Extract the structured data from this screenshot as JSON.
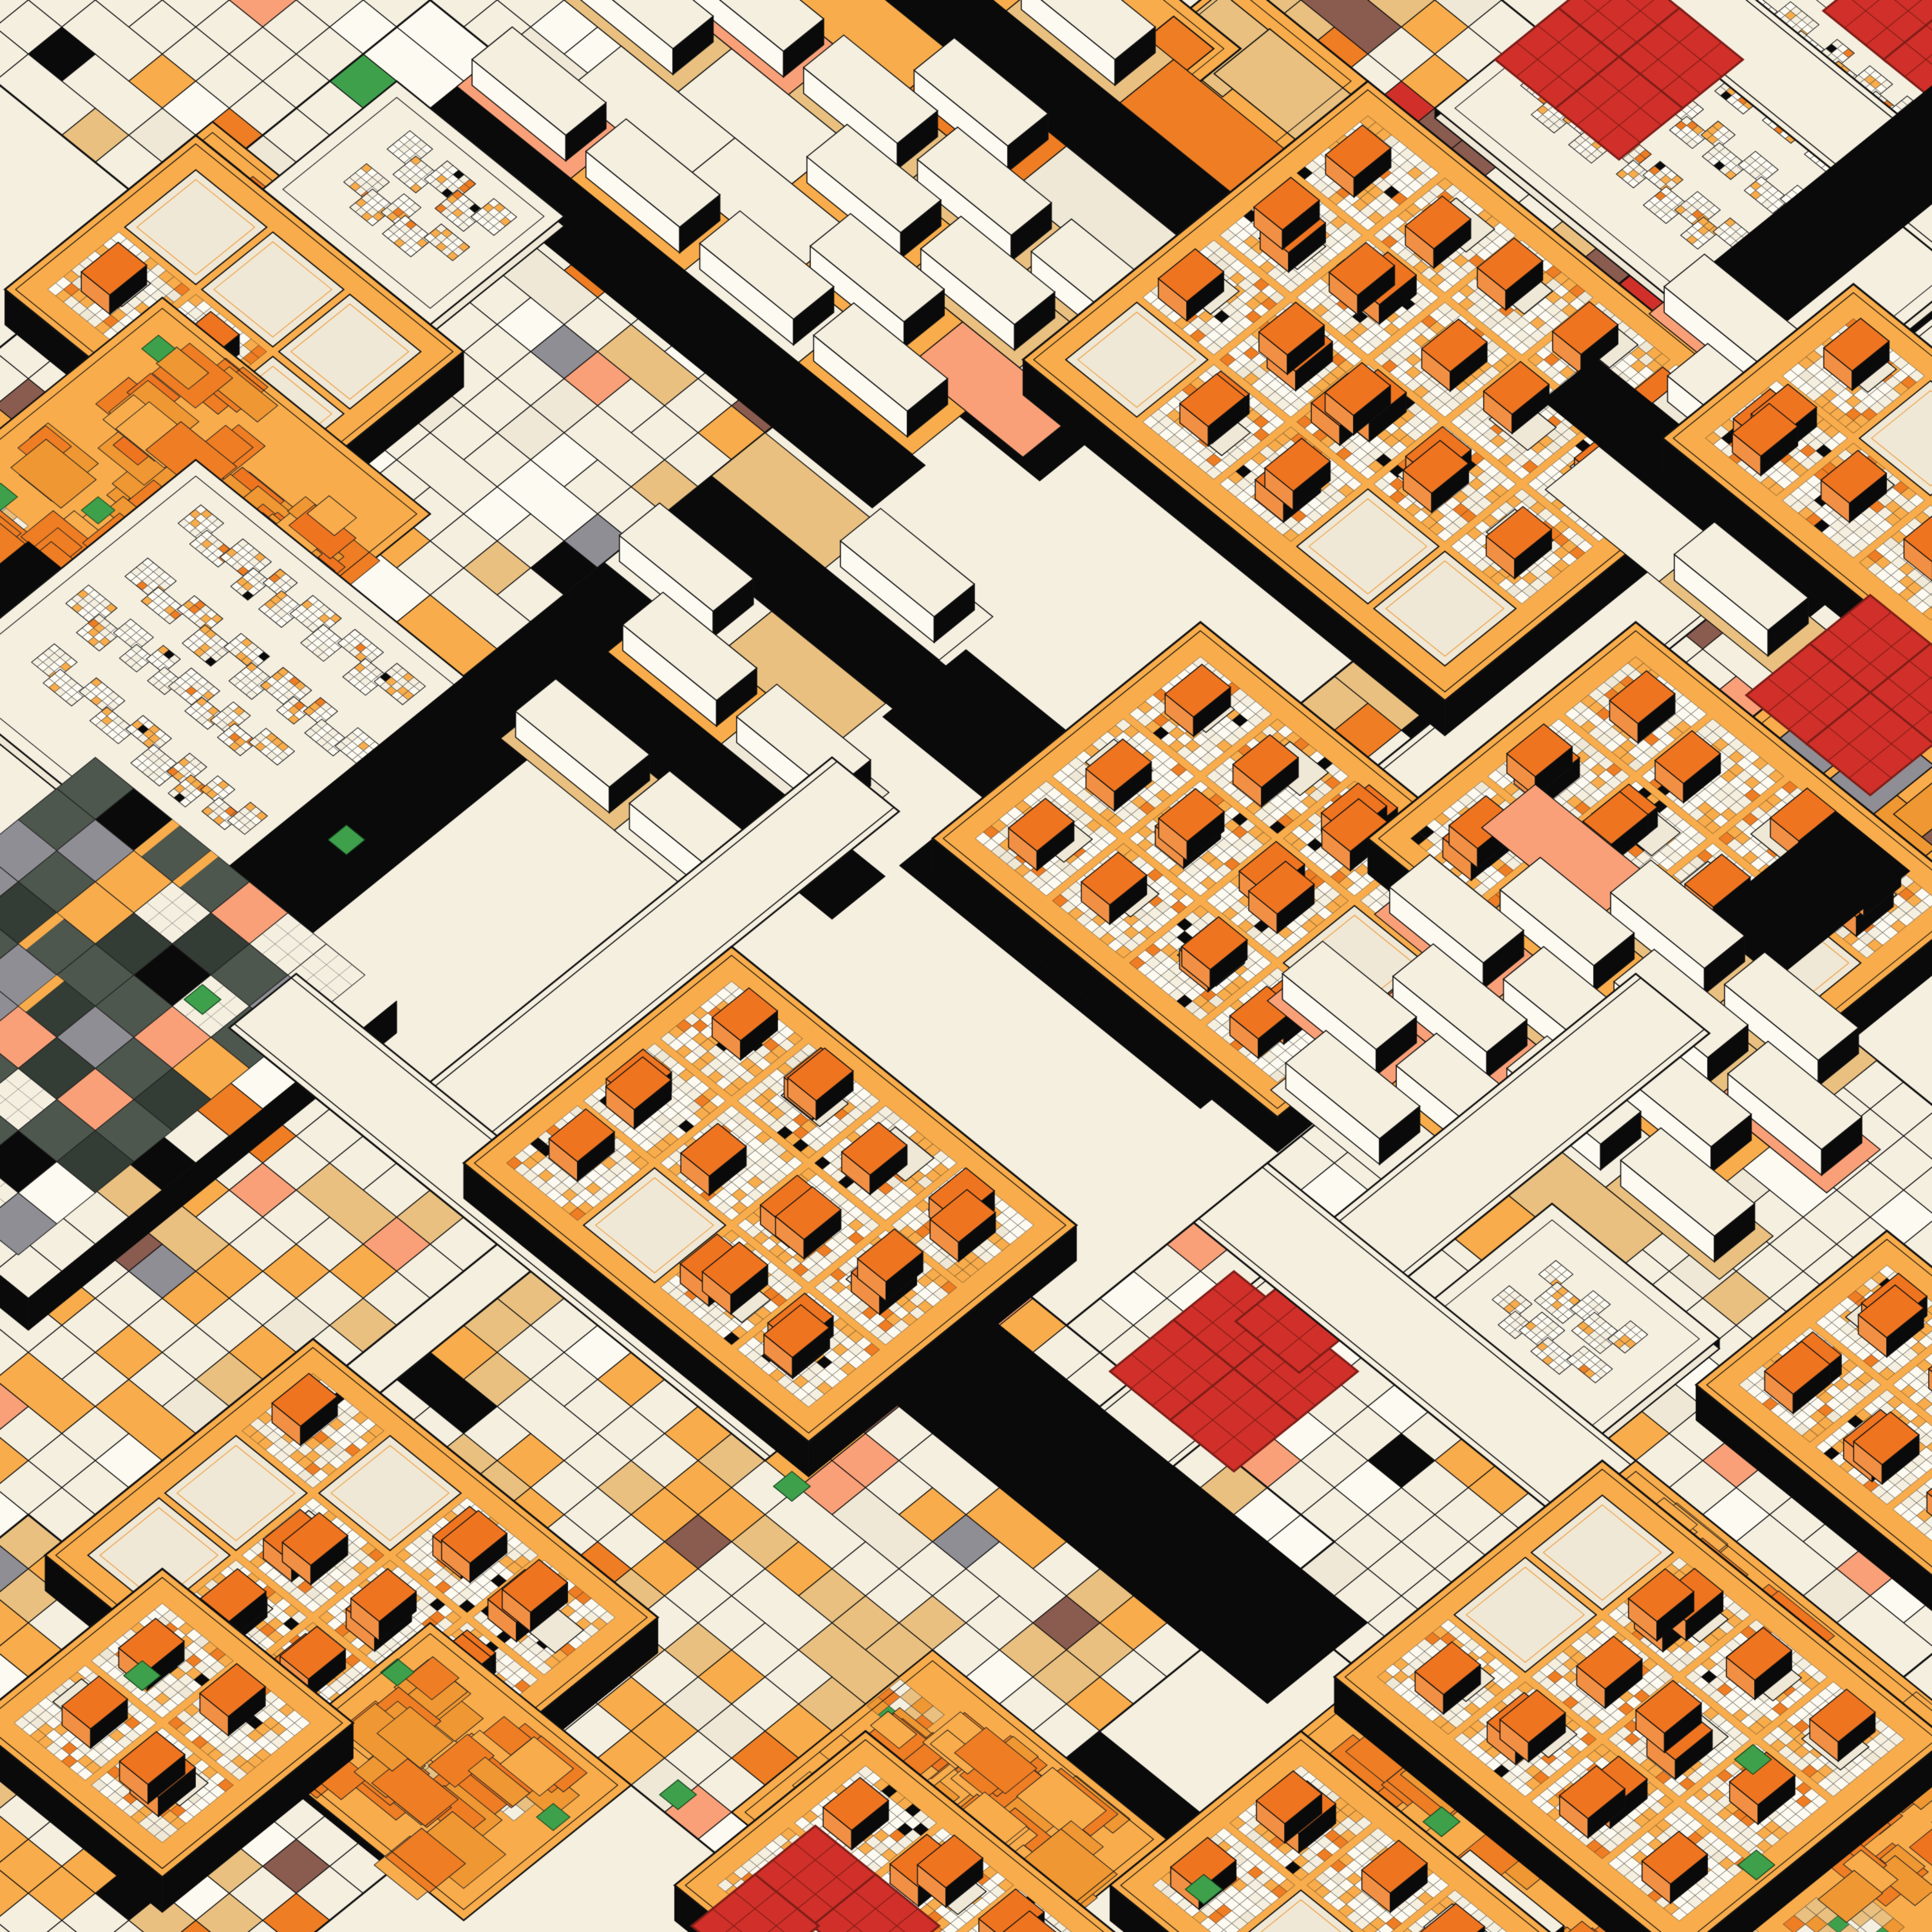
{
  "artwork": {
    "kind": "generative-isometric-circuit-city",
    "background": "#F5EFE0",
    "palette": {
      "cream": "#F5EFE0",
      "cream2": "#EFE8D6",
      "white": "#FDFAF1",
      "ink": "#111111",
      "black": "#0A0A0A",
      "amber": "#F8AC4B",
      "amberDeep": "#EF9732",
      "orange": "#EE7D23",
      "chipTop": "#EF7420",
      "chipSide": "#F19045",
      "tan": "#E9C080",
      "salmon": "#F9A078",
      "gray": "#8F8E94",
      "grayLight": "#B9B8BE",
      "brown": "#8A5B4F",
      "red": "#D03029",
      "redDark": "#7E1D18",
      "green": "#3FA04C",
      "slate": "#4D574E",
      "slateDark": "#343D35"
    },
    "grid": {
      "originX": 1500,
      "originY": 0,
      "axisX": 52,
      "axisY": 42,
      "seed": 20240613
    },
    "styles": {
      "mosaicLight": [
        [
          "cream",
          60
        ],
        [
          "white",
          14
        ],
        [
          "cream2",
          8
        ],
        [
          "amber",
          5
        ],
        [
          "tan",
          4
        ],
        [
          "salmon",
          2
        ],
        [
          "gray",
          1.5
        ],
        [
          "black",
          1.5
        ],
        [
          "brown",
          1
        ],
        [
          "orange",
          1
        ],
        [
          "green",
          0.4
        ],
        [
          "red",
          0.3
        ]
      ],
      "mosaicWarm": [
        [
          "cream",
          38
        ],
        [
          "tan",
          18
        ],
        [
          "amber",
          16
        ],
        [
          "salmon",
          7
        ],
        [
          "white",
          6
        ],
        [
          "orange",
          4
        ],
        [
          "cream2",
          4
        ],
        [
          "gray",
          2
        ],
        [
          "brown",
          2
        ],
        [
          "black",
          2
        ],
        [
          "green",
          0.4
        ],
        [
          "red",
          0.3
        ]
      ],
      "fine": [
        [
          "white",
          40
        ],
        [
          "cream",
          28
        ],
        [
          "amber",
          20
        ],
        [
          "orange",
          6
        ],
        [
          "cream2",
          4
        ],
        [
          "black",
          2
        ]
      ],
      "panelCell": [
        [
          "white",
          52
        ],
        [
          "cream",
          30
        ],
        [
          "amber",
          13
        ],
        [
          "orange",
          3
        ],
        [
          "black",
          1
        ]
      ],
      "slabGround": [
        [
          "tan",
          30
        ],
        [
          "amber",
          26
        ],
        [
          "cream",
          26
        ],
        [
          "salmon",
          9
        ],
        [
          "cream2",
          5
        ],
        [
          "orange",
          4
        ]
      ],
      "afStack": [
        [
          "orange",
          45
        ],
        [
          "amberDeep",
          30
        ],
        [
          "amber",
          20
        ],
        [
          "chipTop",
          5
        ]
      ],
      "afChecker": [
        [
          "tan",
          40
        ],
        [
          "cream",
          30
        ],
        [
          "amberDeep",
          18
        ],
        [
          "orange",
          7
        ],
        [
          "green",
          5
        ]
      ],
      "slateMix": [
        [
          "slate",
          40
        ],
        [
          "slateDark",
          12
        ],
        [
          "cream",
          17
        ],
        [
          "salmon",
          9
        ],
        [
          "gray",
          7
        ],
        [
          "amber",
          5
        ],
        [
          "black",
          6
        ],
        [
          "white",
          4
        ]
      ]
    },
    "elements": [
      {
        "type": "mosaic",
        "u": -18,
        "v": -2,
        "w": 16,
        "h": 18,
        "style": "mosaicLight"
      },
      {
        "type": "mosaic",
        "u": -14,
        "v": -10,
        "w": 12,
        "h": 9,
        "style": "mosaicWarm"
      },
      {
        "type": "mosaic",
        "u": 2,
        "v": -8,
        "w": 13,
        "h": 9,
        "style": "mosaicWarm"
      },
      {
        "type": "mosaic",
        "u": 10,
        "v": -17,
        "w": 9,
        "h": 6,
        "style": "mosaicWarm"
      },
      {
        "type": "mosaic",
        "u": 15,
        "v": -12,
        "w": 14,
        "h": 12,
        "style": "mosaicWarm"
      },
      {
        "type": "mosaic",
        "u": -8,
        "v": 8,
        "w": 13,
        "h": 15,
        "style": "mosaicLight"
      },
      {
        "type": "mosaic",
        "u": 18,
        "v": 0,
        "w": 13,
        "h": 11,
        "style": "mosaicWarm"
      },
      {
        "type": "mosaic",
        "u": 26,
        "v": 6,
        "w": 19,
        "h": 19,
        "style": "mosaicLight"
      },
      {
        "type": "mosaic",
        "u": 17,
        "v": 23,
        "w": 17,
        "h": 15,
        "style": "mosaicWarm"
      },
      {
        "type": "mosaic",
        "u": 2,
        "v": 30,
        "w": 14,
        "h": 14,
        "style": "mosaicWarm"
      },
      {
        "type": "mosaic",
        "u": 14,
        "v": 42,
        "w": 12,
        "h": 10,
        "style": "mosaicWarm"
      },
      {
        "type": "flatplate",
        "u": -15,
        "v": -4,
        "w": 9,
        "h": 6.5,
        "bars": "grayBrown"
      },
      {
        "type": "flatplate",
        "u": -6.5,
        "v": -8,
        "w": 8,
        "h": 5.5,
        "bars": "gray"
      },
      {
        "type": "flatplate",
        "u": 3.5,
        "v": -4.5,
        "w": 4,
        "h": 3,
        "bars": "plain"
      },
      {
        "type": "flatplate",
        "u": 0,
        "v": -3.2,
        "w": 5,
        "h": 3.2,
        "bars": "orangeCell"
      },
      {
        "type": "amberfield",
        "u": -9,
        "v": 13.5,
        "w": 4.5,
        "h": 4.5
      },
      {
        "type": "road",
        "u": -2,
        "v": 6,
        "w": 12,
        "h": 1.8
      },
      {
        "type": "slabs",
        "u": -6,
        "v": -2,
        "w": 14,
        "h": 13
      },
      {
        "type": "panel",
        "u": -7,
        "v": 10,
        "w": 5,
        "h": 4
      },
      {
        "type": "panel",
        "u": 9,
        "v": -13,
        "w": 11,
        "h": 8
      },
      {
        "type": "street",
        "u": 8,
        "v": -11.8,
        "w": 14,
        "h": 2
      },
      {
        "type": "redcluster",
        "u": 13,
        "v": -14.5,
        "n": 2
      },
      {
        "type": "road",
        "u": 16,
        "v": -14,
        "w": 2.2,
        "h": 18
      },
      {
        "type": "chipplate",
        "u": -9,
        "v": 14,
        "cols": 3,
        "rows": 2
      },
      {
        "type": "amberfield",
        "u": -6.5,
        "v": 17.5,
        "w": 8,
        "h": 8
      },
      {
        "type": "street",
        "u": 20.3,
        "v": -16,
        "w": 2.2,
        "h": 28
      },
      {
        "type": "chipplate",
        "u": 7.5,
        "v": -4.5,
        "cols": 5,
        "rows": 4
      },
      {
        "type": "redcluster",
        "u": 9,
        "v": -10.5,
        "n": 4
      },
      {
        "type": "slabs",
        "u": 16,
        "v": -6,
        "w": 8,
        "h": 7
      },
      {
        "type": "chipplate",
        "u": 18.5,
        "v": -8,
        "cols": 3,
        "rows": 2
      },
      {
        "type": "flatplate",
        "u": 25,
        "v": -1,
        "w": 6,
        "h": 5,
        "bars": "grayBrown"
      },
      {
        "type": "road",
        "u": -4,
        "v": 24,
        "w": 8,
        "h": 2
      },
      {
        "type": "panel",
        "u": -3,
        "v": 20,
        "w": 10,
        "h": 8
      },
      {
        "type": "road",
        "u": 5,
        "v": 15,
        "w": 2.5,
        "h": 14
      },
      {
        "type": "road",
        "u": 12,
        "v": 12,
        "w": 14,
        "h": 2.5
      },
      {
        "type": "road",
        "u": 15,
        "v": 14,
        "w": 9,
        "h": 3
      },
      {
        "type": "slabs",
        "u": 5,
        "v": 11,
        "w": 10,
        "h": 10
      },
      {
        "type": "chipplate",
        "u": 15,
        "v": 8,
        "cols": 4,
        "rows": 3
      },
      {
        "type": "redcluster",
        "u": 24.5,
        "v": -2.5,
        "n": 4
      },
      {
        "type": "chipplate",
        "u": 21.5,
        "v": 1.5,
        "cols": 4,
        "rows": 3
      },
      {
        "type": "street",
        "u": 12,
        "v": 16,
        "w": 2,
        "h": 14
      },
      {
        "type": "road",
        "u": 28,
        "v": 2,
        "w": 2.2,
        "h": 14
      },
      {
        "type": "slabs",
        "u": 23,
        "v": 6,
        "w": 11,
        "h": 11
      },
      {
        "type": "street",
        "u": 28,
        "v": 8,
        "w": 2.2,
        "h": 18
      },
      {
        "type": "slate",
        "u": 1,
        "v": 27,
        "w": 9,
        "h": 11
      },
      {
        "type": "panel",
        "u": 31,
        "v": 13.5,
        "w": 5,
        "h": 4
      },
      {
        "type": "redcluster",
        "u": 41.5,
        "v": 12.5,
        "n": 2
      },
      {
        "type": "street",
        "u": 8,
        "v": 28,
        "w": 16,
        "h": 2
      },
      {
        "type": "road",
        "u": 20,
        "v": 24,
        "w": 16,
        "h": 3
      },
      {
        "type": "chipplate",
        "u": 14,
        "v": 21,
        "cols": 4,
        "rows": 3
      },
      {
        "type": "redcluster",
        "u": 27.5,
        "v": 19.5,
        "n": 5
      },
      {
        "type": "street",
        "u": 26,
        "v": 17,
        "w": 18,
        "h": 2.2
      },
      {
        "type": "chipplate",
        "u": 36.5,
        "v": 9,
        "cols": 3,
        "rows": 2
      },
      {
        "type": "amberfield",
        "u": 37,
        "v": 17,
        "w": 13.5,
        "h": 11
      },
      {
        "type": "slabs",
        "u": 42,
        "v": 27,
        "w": 7,
        "h": 7
      },
      {
        "type": "chipplate",
        "u": 36.5,
        "v": 17.5,
        "cols": 4,
        "rows": 3
      },
      {
        "type": "chipplate",
        "u": 15,
        "v": 34.5,
        "cols": 4,
        "rows": 3
      },
      {
        "type": "road",
        "u": 34,
        "v": 30,
        "w": 10,
        "h": 2.2
      },
      {
        "type": "amberfield",
        "u": 30,
        "v": 31,
        "w": 7,
        "h": 6
      },
      {
        "type": "amberfield",
        "u": 22,
        "v": 38,
        "w": 6,
        "h": 5
      },
      {
        "type": "chipplate",
        "u": 17,
        "v": 41,
        "cols": 2,
        "rows": 2
      },
      {
        "type": "chipplate",
        "u": 37,
        "v": 27,
        "cols": 3,
        "rows": 2
      },
      {
        "type": "chipplate",
        "u": 30.5,
        "v": 33.5,
        "cols": 3,
        "rows": 2
      },
      {
        "type": "redcluster",
        "u": 31.5,
        "v": 36,
        "n": 3
      },
      {
        "type": "greens",
        "points": [
          [
            6,
            24.5
          ],
          [
            6.8,
            29.6
          ],
          [
            44,
            20.5
          ],
          [
            28.6,
            37.2
          ],
          [
            40.5,
            26.3
          ],
          [
            46,
            22.4
          ],
          [
            34.4,
            40.2
          ],
          [
            24.6,
            29.8
          ],
          [
            38.2,
            31.1
          ],
          [
            18.4,
            43
          ]
        ]
      }
    ]
  }
}
